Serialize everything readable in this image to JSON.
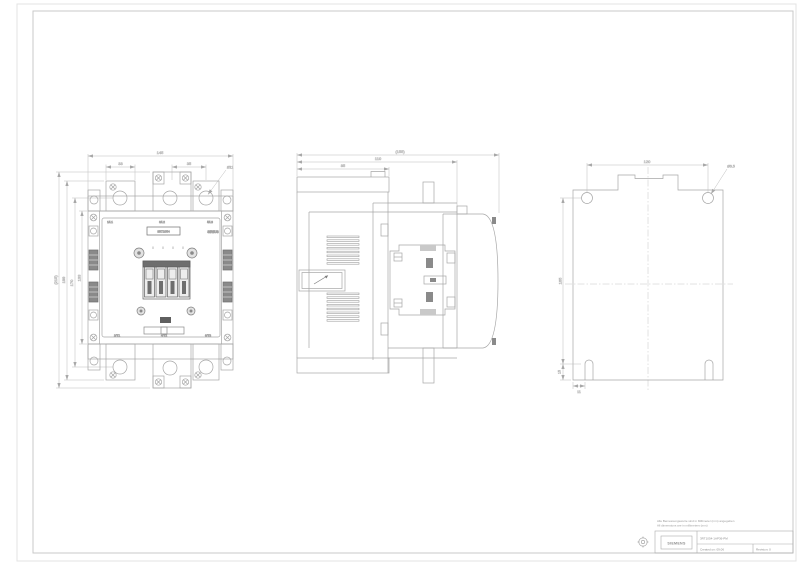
{
  "front_view": {
    "terminals_top": [
      "1/L1",
      "3/L2",
      "5/L3"
    ],
    "terminals_bottom": [
      "2/T1",
      "4/T2",
      "6/T3"
    ],
    "brand_label": "SIRIUS",
    "device_label": "3RT1054",
    "dim_width_total": "145",
    "dim_lug_left": "33",
    "dim_lug_right": "35",
    "dim_hole_dia": "Ø11",
    "dim_height_total": "(215)",
    "dim_height_outer": "199",
    "dim_height_holes": "170",
    "dim_height_body": "133"
  },
  "side_view": {
    "dim_depth_total": "(155)",
    "dim_depth_mid": "110",
    "dim_depth_front": "85"
  },
  "rear_view": {
    "dim_hole_pitch": "120",
    "dim_hole_dia": "Ø6.5",
    "dim_height_holes": "165",
    "dim_slot_offset": "15",
    "dim_slot_edge": "11"
  },
  "title_block": {
    "note_line1": "Alle Bemessungswerte sind in Millimeter (mm) angegeben",
    "note_line2": "All dimensions are in millimeters (mm)",
    "logo_text": "SIEMENS",
    "document_number": "3RT1054-1AP36-PM",
    "field_created": "Created on: 09.06",
    "field_scale": "Revision: 0"
  }
}
